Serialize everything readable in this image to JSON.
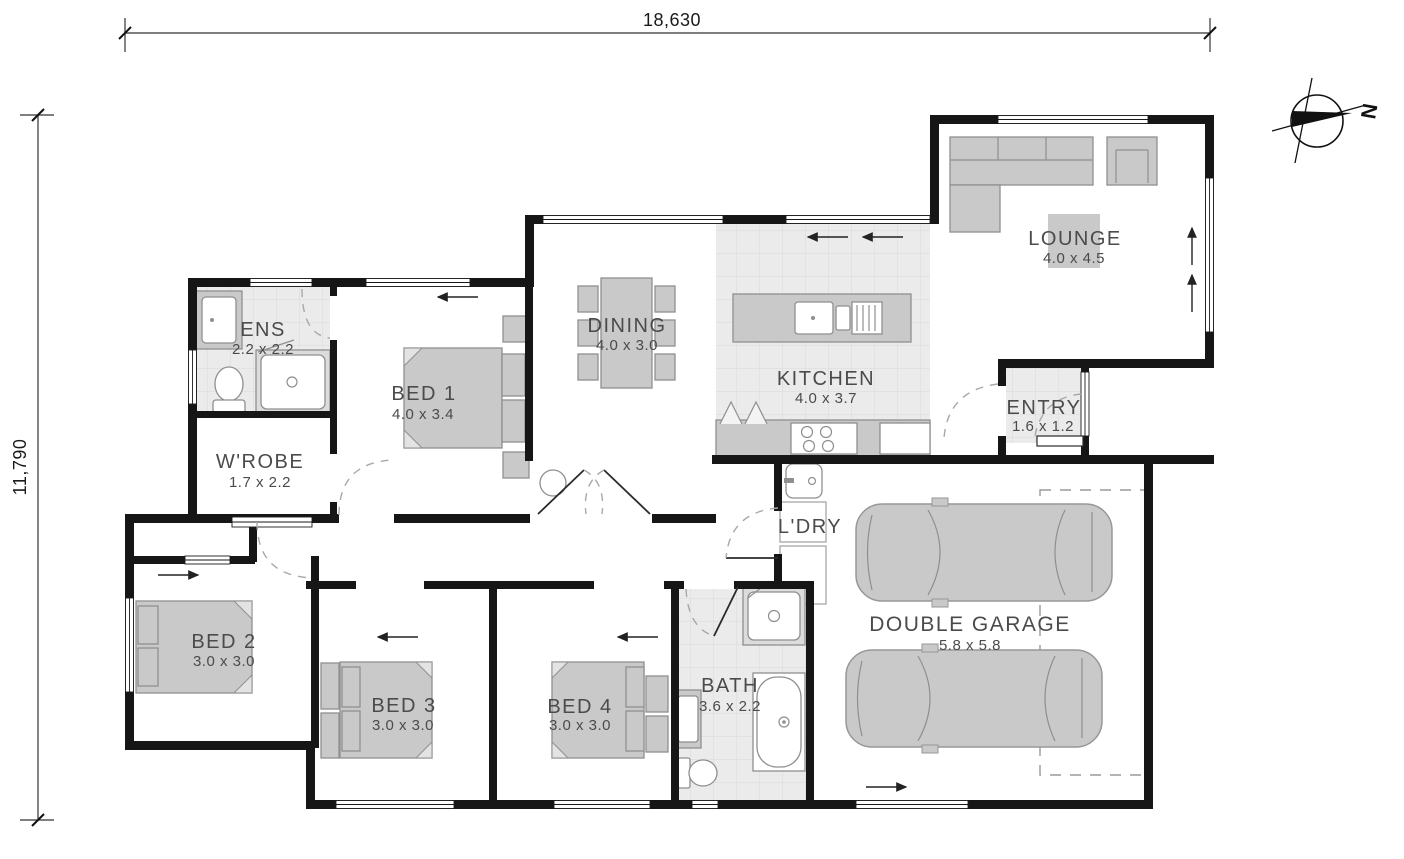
{
  "dimensions": {
    "top": "18,630",
    "left": "11,790"
  },
  "compass": {
    "label": "N"
  },
  "rooms": [
    {
      "name": "ENS",
      "dims": "2.2 x 2.2"
    },
    {
      "name": "W'ROBE",
      "dims": "1.7 x 2.2"
    },
    {
      "name": "BED 1",
      "dims": "4.0 x 3.4"
    },
    {
      "name": "DINING",
      "dims": "4.0 x 3.0"
    },
    {
      "name": "KITCHEN",
      "dims": "4.0 x 3.7"
    },
    {
      "name": "LOUNGE",
      "dims": "4.0 x 4.5"
    },
    {
      "name": "ENTRY",
      "dims": "1.6 x 1.2"
    },
    {
      "name": "L'DRY",
      "dims": ""
    },
    {
      "name": "BED 2",
      "dims": "3.0 x 3.0"
    },
    {
      "name": "BED 3",
      "dims": "3.0 x 3.0"
    },
    {
      "name": "BED 4",
      "dims": "3.0 x 3.0"
    },
    {
      "name": "BATH",
      "dims": "3.6 x 2.2"
    },
    {
      "name": "DOUBLE GARAGE",
      "dims": "5.8 x 5.8"
    }
  ],
  "colors": {
    "wall": "#161616",
    "furniture": "#c9c9c9",
    "tile": "#ebebeb",
    "label": "#4b4b4b"
  }
}
